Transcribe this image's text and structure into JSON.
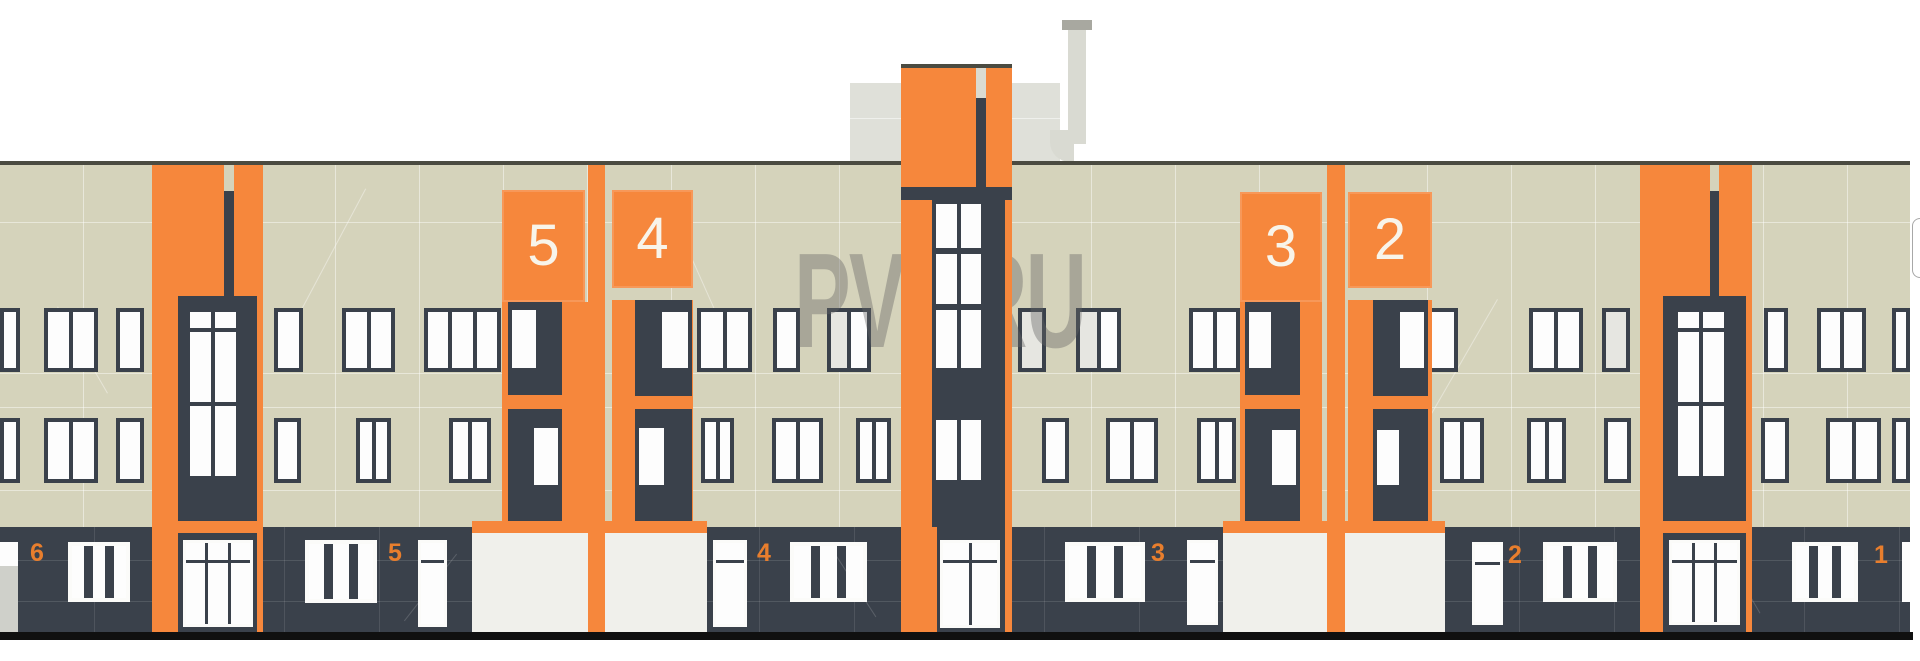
{
  "watermark": "PVT.RU",
  "tower_panels": {
    "t5": "5",
    "t4": "4",
    "t3": "3",
    "t2": "2"
  },
  "ground_numbers": {
    "g6": "6",
    "g5": "5",
    "g4": "4",
    "g3": "3",
    "g2": "2",
    "g1": "1"
  },
  "palette": {
    "orange": "#F6873C",
    "orange_deep": "#E87E2D",
    "beige": "#D5D3BB",
    "dark": "#3A414B",
    "gray_box": "#DFE0D9",
    "pipe": "#D9DAD2",
    "roofline": "#4B4B41",
    "baseline": "#101010",
    "storefront": "#F0F0EB",
    "watermark": "rgba(100,100,100,0.40)",
    "page_background": "#FFFFFF"
  }
}
